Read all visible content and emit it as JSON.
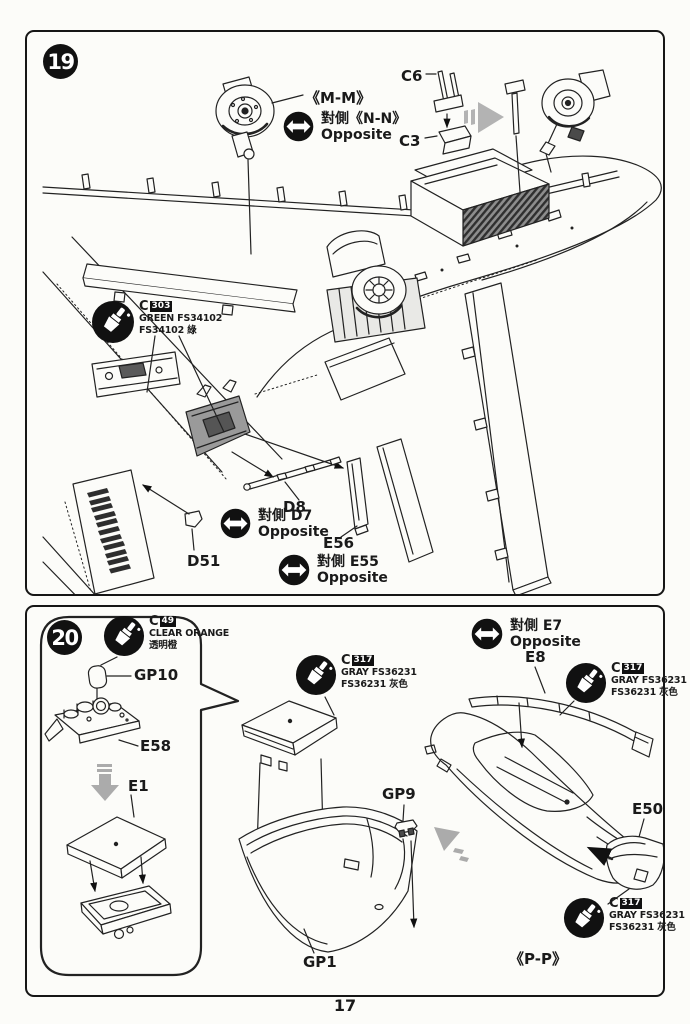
{
  "page": {
    "number": "17"
  },
  "step19": {
    "badge": "19",
    "mm": "《M-M》",
    "nn": {
      "cn": "對側《N-N》",
      "en": "Opposite"
    },
    "c6": "C6",
    "c3": "C3",
    "paint_green": {
      "code": "C",
      "num": "303",
      "line1": "GREEN FS34102",
      "line2": "FS34102 綠"
    },
    "d8": "D8",
    "d7": {
      "cn": "對側 D7",
      "en": "Opposite"
    },
    "e56": "E56",
    "e55": {
      "cn": "對側 E55",
      "en": "Opposite"
    },
    "d51": "D51"
  },
  "step20": {
    "badge": "20",
    "paint_orange": {
      "code": "C",
      "num": "49",
      "line1": "CLEAR ORANGE",
      "line2": "透明橙"
    },
    "gp10": "GP10",
    "e58": "E58",
    "e1": "E1",
    "paint_gray_mid": {
      "code": "C",
      "num": "317",
      "line1": "GRAY FS36231",
      "line2": "FS36231 灰色"
    },
    "e7": {
      "cn": "對側 E7",
      "en": "Opposite"
    },
    "e8": "E8",
    "paint_gray_right": {
      "code": "C",
      "num": "317",
      "line1": "GRAY FS36231",
      "line2": "FS36231 灰色"
    },
    "gp9": "GP9",
    "gp1": "GP1",
    "e50": "E50",
    "paint_gray_bottom": {
      "code": "C",
      "num": "317",
      "line1": "GRAY FS36231",
      "line2": "FS36231 灰色"
    },
    "pp": "《P-P》"
  }
}
